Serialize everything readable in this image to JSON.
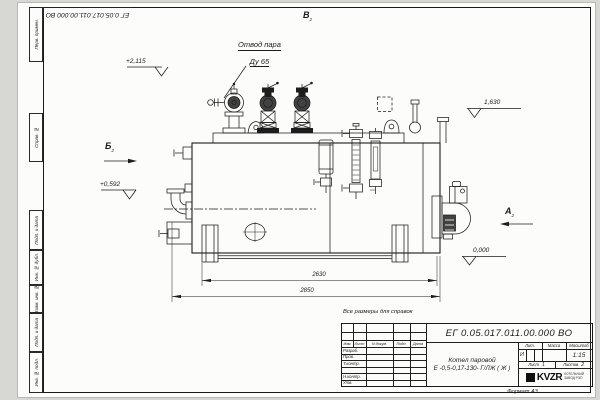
{
  "drawing": {
    "doc_number": "ЕГ 0.05.017.011.00.000  ВО",
    "reference_note": "Все размеры для справок",
    "format_label": "Формат А3",
    "callout": {
      "line1": "Отвод пара",
      "line2": "Ду 65"
    },
    "elevations": {
      "top": "+2,115",
      "left": "+0,592",
      "right": "1,630",
      "zero": "0,000"
    },
    "dimensions": {
      "inner": "2630",
      "overall": "2850"
    },
    "views": {
      "a": "А",
      "b": "Б",
      "v": "В",
      "ref": "2"
    }
  },
  "margin_labels": [
    "Перв. примен.",
    "Справ. №",
    "Подп. и дата",
    "Инв. № дубл.",
    "Взам. инв. №",
    "Подп. и дата",
    "Инв. № подл."
  ],
  "title_block": {
    "product_line1": "Котел паровой",
    "product_line2": "Е -0,5-0,17-130- Г/ЛЖ ( Ж )",
    "columns": {
      "izm": "Изм.",
      "list": "Лист",
      "doc": "N докум.",
      "sign": "Подп.",
      "date": "Дата"
    },
    "roles": [
      "Разраб.",
      "Пров.",
      "Т.контр.",
      "Н.контр.",
      "Утв."
    ],
    "lit_label": "Лит.",
    "lit_value": "И",
    "mass_label": "Масса",
    "scale_label": "Масштаб",
    "scale_value": "1:15",
    "sheet_label": "Лист",
    "sheet_value": "1",
    "sheets_label": "Листов",
    "sheets_value": "2",
    "company": {
      "logo": "KVZR",
      "sub1": "КОТЕЛЬНЫЙ",
      "sub2": "ЗАВОД РЭП"
    }
  }
}
